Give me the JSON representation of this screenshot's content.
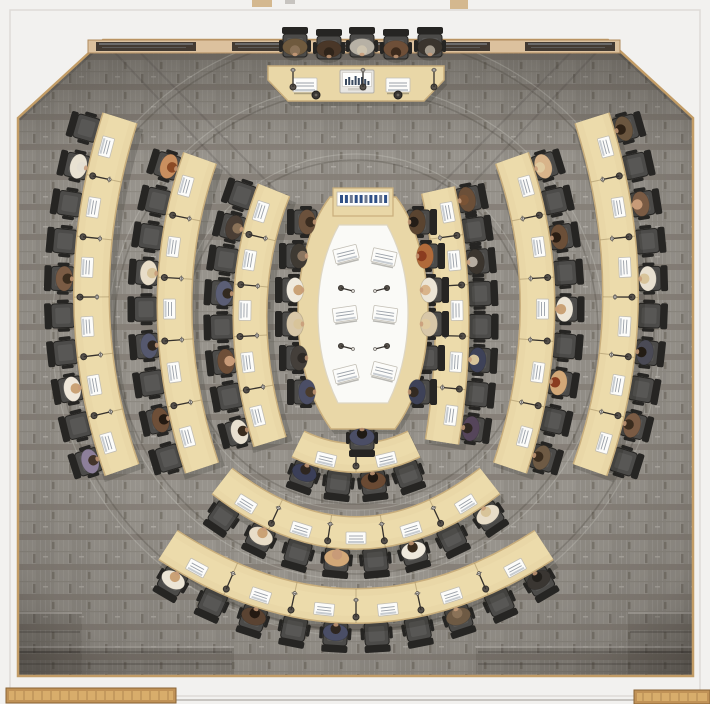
{
  "scene": {
    "width": 710,
    "height": 704,
    "type": "council-chamber-top-down-render"
  },
  "palette": {
    "outside": "#f2f1ef",
    "outerWallLine": "#dedbd7",
    "trim": "#c29c66",
    "carpetBase": "#97938c",
    "carpetHalf": "#918d86",
    "carpetLine1": "#a29e97",
    "carpetLine2": "#a6a29b",
    "carpetBand": "#857f77",
    "carpetMid": "#8d8981",
    "carpetNotch1": "#7b766d",
    "carpetNotch2": "#7d7870",
    "carpetDash": "#b3afa7",
    "wood": "#e9d7a7",
    "woodEdge": "#c9ae7c",
    "woodLight": "#efdfb2",
    "tableInner": "#fafaf7",
    "tableInnerEdge": "#ded6c2",
    "chair": "#4c4b49",
    "chairDark": "#262523",
    "chairMid": "#585755",
    "paper": "#fcfcfa",
    "paperEdge": "#c2beb4",
    "paperLine": "#9aa0a8",
    "paperBar": "#b9bfc7",
    "mic": "#55504a",
    "micDark": "#35312d",
    "skin": "#c89b78",
    "credenzaWood": "#dcc19e",
    "credenzaEdge": "#b08a5e",
    "credenzaGlass": "#433a32",
    "credenzaGlassHi": "#b9c8d4",
    "bench": "#c09257",
    "benchLight": "#d8ad6b",
    "benchSlat": "#8a6436",
    "consoleBtnA": "#2f4f86",
    "consoleBtnB": "#6b7890",
    "shadow": "rgba(30,28,24,0.18)",
    "seamDark": "rgba(62,58,53,0.25)",
    "seamLight": "rgba(232,230,224,0.22)",
    "stepShade": "rgba(60,55,48,0.16)",
    "stepLine": "rgba(40,36,32,0.30)",
    "deskSeam": "rgba(120,96,56,0.35)"
  },
  "room": {
    "carpetPolygon": "18,118 103,40 608,40 693,118 693,676 18,676",
    "outerWallRect": [
      10,
      10,
      690,
      686
    ],
    "chamferShadows": [
      [
        18,
        118,
        103,
        40
      ],
      [
        608,
        40,
        693,
        118
      ]
    ],
    "bottomEdgeLine": [
      170,
      700,
      706,
      700
    ],
    "topMarks": [
      {
        "x": 252,
        "y": 0,
        "w": 20,
        "h": 7,
        "color": "#d4b88f"
      },
      {
        "x": 450,
        "y": 0,
        "w": 18,
        "h": 9,
        "color": "#d4b88f"
      },
      {
        "x": 285,
        "y": 0,
        "w": 10,
        "h": 4,
        "color": "#c7c4c0"
      }
    ],
    "benches": [
      {
        "x": 6,
        "y": 688,
        "w": 170,
        "h": 15
      },
      {
        "x": 634,
        "y": 690,
        "w": 76,
        "h": 14
      }
    ],
    "steps": [
      {
        "x": 16,
        "y": 612,
        "w": 66,
        "h": 62,
        "lines": [
          632,
          652
        ]
      },
      {
        "x": 16,
        "y": 646,
        "w": 218,
        "h": 28,
        "lines": [
          652,
          664
        ]
      },
      {
        "x": 628,
        "y": 612,
        "w": 66,
        "h": 62,
        "lines": [
          632,
          652
        ]
      },
      {
        "x": 476,
        "y": 646,
        "w": 218,
        "h": 28,
        "lines": [
          652,
          664
        ]
      }
    ],
    "credenza": {
      "x": 88,
      "y": 40,
      "w": 532,
      "h": 13,
      "glassY": 42,
      "glassH": 9,
      "glass": [
        [
          96,
          100
        ],
        [
          232,
          62
        ],
        [
          330,
          58
        ],
        [
          432,
          58
        ],
        [
          525,
          90
        ]
      ]
    }
  },
  "carpet": {
    "center": [
      356,
      332
    ],
    "seamRadii": [
      172,
      242,
      298
    ],
    "diagSeams": [
      [
        103,
        40,
        268,
        215
      ],
      [
        128,
        40,
        290,
        205
      ],
      [
        608,
        40,
        443,
        215
      ],
      [
        583,
        40,
        421,
        205
      ]
    ],
    "topShadeRect": [
      18,
      40,
      675,
      115
    ]
  },
  "podium": {
    "deskPolygon": "268,66 444,66 444,80 424,101 288,101 268,80",
    "papers": [
      [
        305,
        85
      ],
      [
        398,
        85
      ]
    ],
    "laptop": {
      "x": 340,
      "y": 70,
      "w": 34,
      "h": 23,
      "bars": [
        6,
        8,
        5,
        9,
        7,
        8,
        6,
        4
      ]
    },
    "mics": [
      [
        293,
        87
      ],
      [
        363,
        87
      ],
      [
        434,
        87
      ]
    ],
    "knobs": [
      [
        316,
        95
      ],
      [
        398,
        95
      ]
    ],
    "chairs": [
      {
        "x": 295,
        "y": 44,
        "c": "#6f5a3e",
        "h": "#8a7258"
      },
      {
        "x": 329,
        "y": 46,
        "c": "#4a3728",
        "h": "#2f241a"
      },
      {
        "x": 362,
        "y": 44,
        "c": "#b7b1a5",
        "h": "#cdc3ae"
      },
      {
        "x": 396,
        "y": 46,
        "c": "#6e4f38",
        "h": "#3c2a1c"
      },
      {
        "x": 430,
        "y": 44,
        "c": "#3b352e",
        "h": "#a39a8c"
      }
    ]
  },
  "arcs": [
    {
      "id": "desk-arc-left-outer",
      "p": [
        120,
        118,
        62,
        300,
        122,
        470
      ],
      "w": 37,
      "side": 1,
      "chairs": 10,
      "papers": 6,
      "occ": {
        "1": [
          "#e9e2d2",
          "#e5dfd2"
        ],
        "4": [
          "#7a5b44",
          "#3a2c1e"
        ],
        "7": [
          "#efe7da",
          "#caa276"
        ],
        "9": [
          "#8d7f9a",
          "#43342a"
        ]
      }
    },
    {
      "id": "desk-arc-left-middle",
      "p": [
        200,
        158,
        148,
        305,
        202,
        468
      ],
      "w": 36,
      "side": 1,
      "chairs": 9,
      "papers": 5,
      "occ": {
        "0": [
          "#c98f5f",
          "#8a4a26"
        ],
        "3": [
          "#e8ddc8",
          "#d8c49a"
        ],
        "5": [
          "#55586e",
          "#2e2620"
        ],
        "7": [
          "#6e4f38",
          "#241a12"
        ]
      }
    },
    {
      "id": "desk-arc-left-inner",
      "p": [
        274,
        190,
        228,
        305,
        270,
        442
      ],
      "w": 35,
      "side": 1,
      "chairs": 8,
      "papers": 5,
      "occ": {
        "1": [
          "#4a3e35",
          "#8a7258"
        ],
        "3": [
          "#5b5e75",
          "#332a20"
        ],
        "5": [
          "#6e4f38",
          "#c89b78"
        ],
        "7": [
          "#e8e0d0",
          "#3a2c1e"
        ]
      }
    },
    {
      "id": "desk-arc-right-outer",
      "p": [
        592,
        118,
        650,
        300,
        590,
        470
      ],
      "w": 37,
      "side": -1,
      "chairs": 10,
      "papers": 6,
      "occ": {
        "0": [
          "#6b563f",
          "#2e2115"
        ],
        "2": [
          "#7a5b44",
          "#c89b78"
        ],
        "4": [
          "#e8e0d0",
          "#d8c49a"
        ],
        "6": [
          "#4a4a55",
          "#231c14"
        ],
        "8": [
          "#7a5b44",
          "#3a2c1e"
        ]
      }
    },
    {
      "id": "desk-arc-right-middle",
      "p": [
        512,
        158,
        564,
        305,
        510,
        468
      ],
      "w": 36,
      "side": -1,
      "chairs": 9,
      "papers": 5,
      "occ": {
        "0": [
          "#d8b48a",
          "#e0cba0"
        ],
        "2": [
          "#6b4f38",
          "#2a1e14"
        ],
        "4": [
          "#ece5d6",
          "#caa276"
        ],
        "6": [
          "#d2a878",
          "#8a3c20"
        ],
        "8": [
          "#6e5a44",
          "#3a2c1e"
        ]
      }
    },
    {
      "id": "desk-arc-right-inner",
      "p": [
        438,
        190,
        464,
        305,
        442,
        442
      ],
      "w": 35,
      "side": -1,
      "chairs": 8,
      "papers": 5,
      "occ": {
        "0": [
          "#6b4f38",
          "#7a5335"
        ],
        "2": [
          "#3b352e",
          "#b5aca0"
        ],
        "5": [
          "#3e4258",
          "#d8c49a"
        ],
        "7": [
          "#55455a",
          "#2e2620"
        ]
      }
    },
    {
      "id": "desk-arc-bottom-middle",
      "p": [
        222,
        481,
        356,
        585,
        490,
        481
      ],
      "w": 34,
      "side": 1,
      "chairs": 8,
      "papers": 5,
      "occ": {
        "1": [
          "#e8ddc8",
          "#caa276"
        ],
        "3": [
          "#d2a878",
          "#c89b78"
        ],
        "5": [
          "#efe9dc",
          "#3a2c1e"
        ],
        "7": [
          "#e8ddc8",
          "#d8c49a"
        ]
      }
    },
    {
      "id": "desk-arc-bottom-outer",
      "p": [
        168,
        545,
        356,
        667,
        544,
        545
      ],
      "w": 36,
      "side": 1,
      "chairs": 10,
      "papers": 6,
      "occ": {
        "0": [
          "#ece5d6",
          "#caa276"
        ],
        "2": [
          "#5a4332",
          "#241a12"
        ],
        "4": [
          "#4a4e66",
          "#2e2620"
        ],
        "7": [
          "#6e5a44",
          "#8a7258"
        ],
        "9": [
          "#3a3632",
          "#23201c"
        ]
      }
    },
    {
      "id": "desk-arc-bottom-inner",
      "p": [
        298,
        444,
        356,
        472,
        414,
        444
      ],
      "w": 30,
      "side": 1,
      "chairs": 4,
      "papers": 2,
      "occ": {
        "0": [
          "#3b3f58",
          "#2e2620"
        ],
        "2": [
          "#6a4a33",
          "#1f1812"
        ]
      }
    }
  ],
  "centerTable": {
    "outline": "M330,197 L396,197 C417,224 428,270 428,313 C428,354 419,396 395,429 L331,429 C307,396 298,354 298,313 C298,270 309,224 330,197 Z",
    "inner": "M339,225 L387,225 C402,252 408,283 408,313 C408,344 402,375 388,403 L338,403 C324,375 318,344 318,313 C318,283 324,252 339,225 Z",
    "console": {
      "x": 333,
      "y": 188,
      "w": 60,
      "h": 28,
      "buttons": 10
    },
    "tablets": [
      [
        346,
        254,
        -14
      ],
      [
        384,
        257,
        12
      ],
      [
        345,
        314,
        -8
      ],
      [
        385,
        314,
        8
      ],
      [
        346,
        374,
        -14
      ],
      [
        384,
        371,
        14
      ]
    ],
    "mics": [
      [
        341,
        288,
        1
      ],
      [
        387,
        288,
        -1
      ],
      [
        341,
        346,
        1
      ],
      [
        387,
        346,
        -1
      ]
    ],
    "chairs": {
      "ys": [
        222,
        256,
        290,
        324,
        358,
        392
      ],
      "leftXs": [
        304,
        296,
        292,
        292,
        296,
        304
      ],
      "rightXs": [
        420,
        428,
        432,
        432,
        428,
        420
      ],
      "leftOcc": [
        [
          "#6b513c",
          "#3a2c20"
        ],
        [
          "#3f3a33",
          "#8a7560"
        ],
        [
          "#efe9dc",
          "#caa276"
        ],
        [
          "#d8c7a8",
          "#d8c49a"
        ],
        [
          "#443f3a",
          "#2e2a26"
        ],
        [
          "#4b4e66",
          "#4a3b2c"
        ]
      ],
      "rightOcc": [
        [
          "#5a4430",
          "#241d17"
        ],
        [
          "#b06a3a",
          "#8a3c20"
        ],
        [
          "#ece5d6",
          "#d9b48a"
        ],
        [
          "#d8c7a8",
          "#e0cba0"
        ],
        null,
        [
          "#3e4258",
          "#332a22"
        ]
      ],
      "bottom": {
        "x": 362,
        "y": 440,
        "occ": [
          "#4b4e66",
          "#1f1a15"
        ]
      }
    }
  }
}
